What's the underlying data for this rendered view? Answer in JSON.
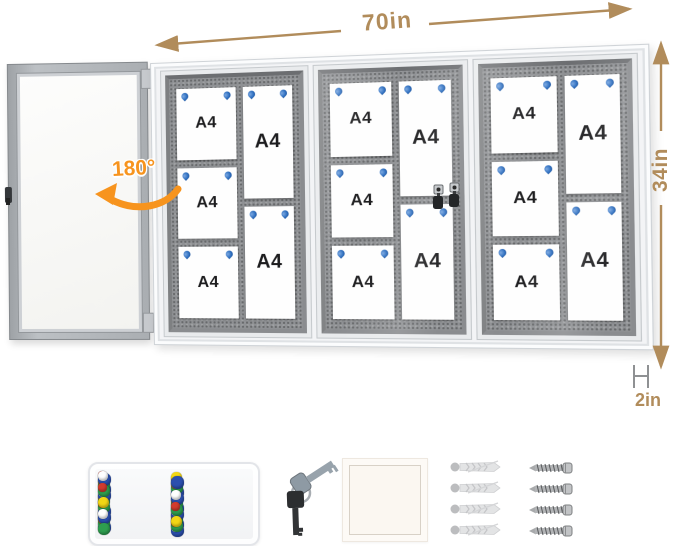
{
  "annotations": {
    "width_label": "70in",
    "height_label": "34in",
    "depth_label": "2in",
    "swing_label": "180°"
  },
  "colors": {
    "dimension_text": "#b18c5b",
    "swing_accent": "#f7941e",
    "pin_blue": "#2e6fc0",
    "felt_gray": "#8f9194"
  },
  "board": {
    "paper_label": "A4",
    "sections": [
      {
        "door": "open",
        "columns": [
          {
            "type": "landscape",
            "papers": [
              "A4",
              "A4",
              "A4"
            ]
          },
          {
            "type": "portrait",
            "papers": [
              "A4",
              "A4"
            ]
          }
        ]
      },
      {
        "door": "locked",
        "columns": [
          {
            "type": "landscape",
            "papers": [
              "A4",
              "A4",
              "A4"
            ]
          },
          {
            "type": "portrait",
            "papers": [
              "A4",
              "A4"
            ]
          }
        ]
      },
      {
        "door": "locked",
        "columns": [
          {
            "type": "landscape",
            "papers": [
              "A4",
              "A4",
              "A4"
            ]
          },
          {
            "type": "portrait",
            "papers": [
              "A4",
              "A4"
            ]
          }
        ]
      }
    ]
  },
  "accessories": {
    "pushpin_colors": [
      "#d23b2e",
      "#2b4fae",
      "#2e9e4f",
      "#f2d715",
      "#ffffff"
    ],
    "anchor_count": 4,
    "screw_count": 4
  }
}
